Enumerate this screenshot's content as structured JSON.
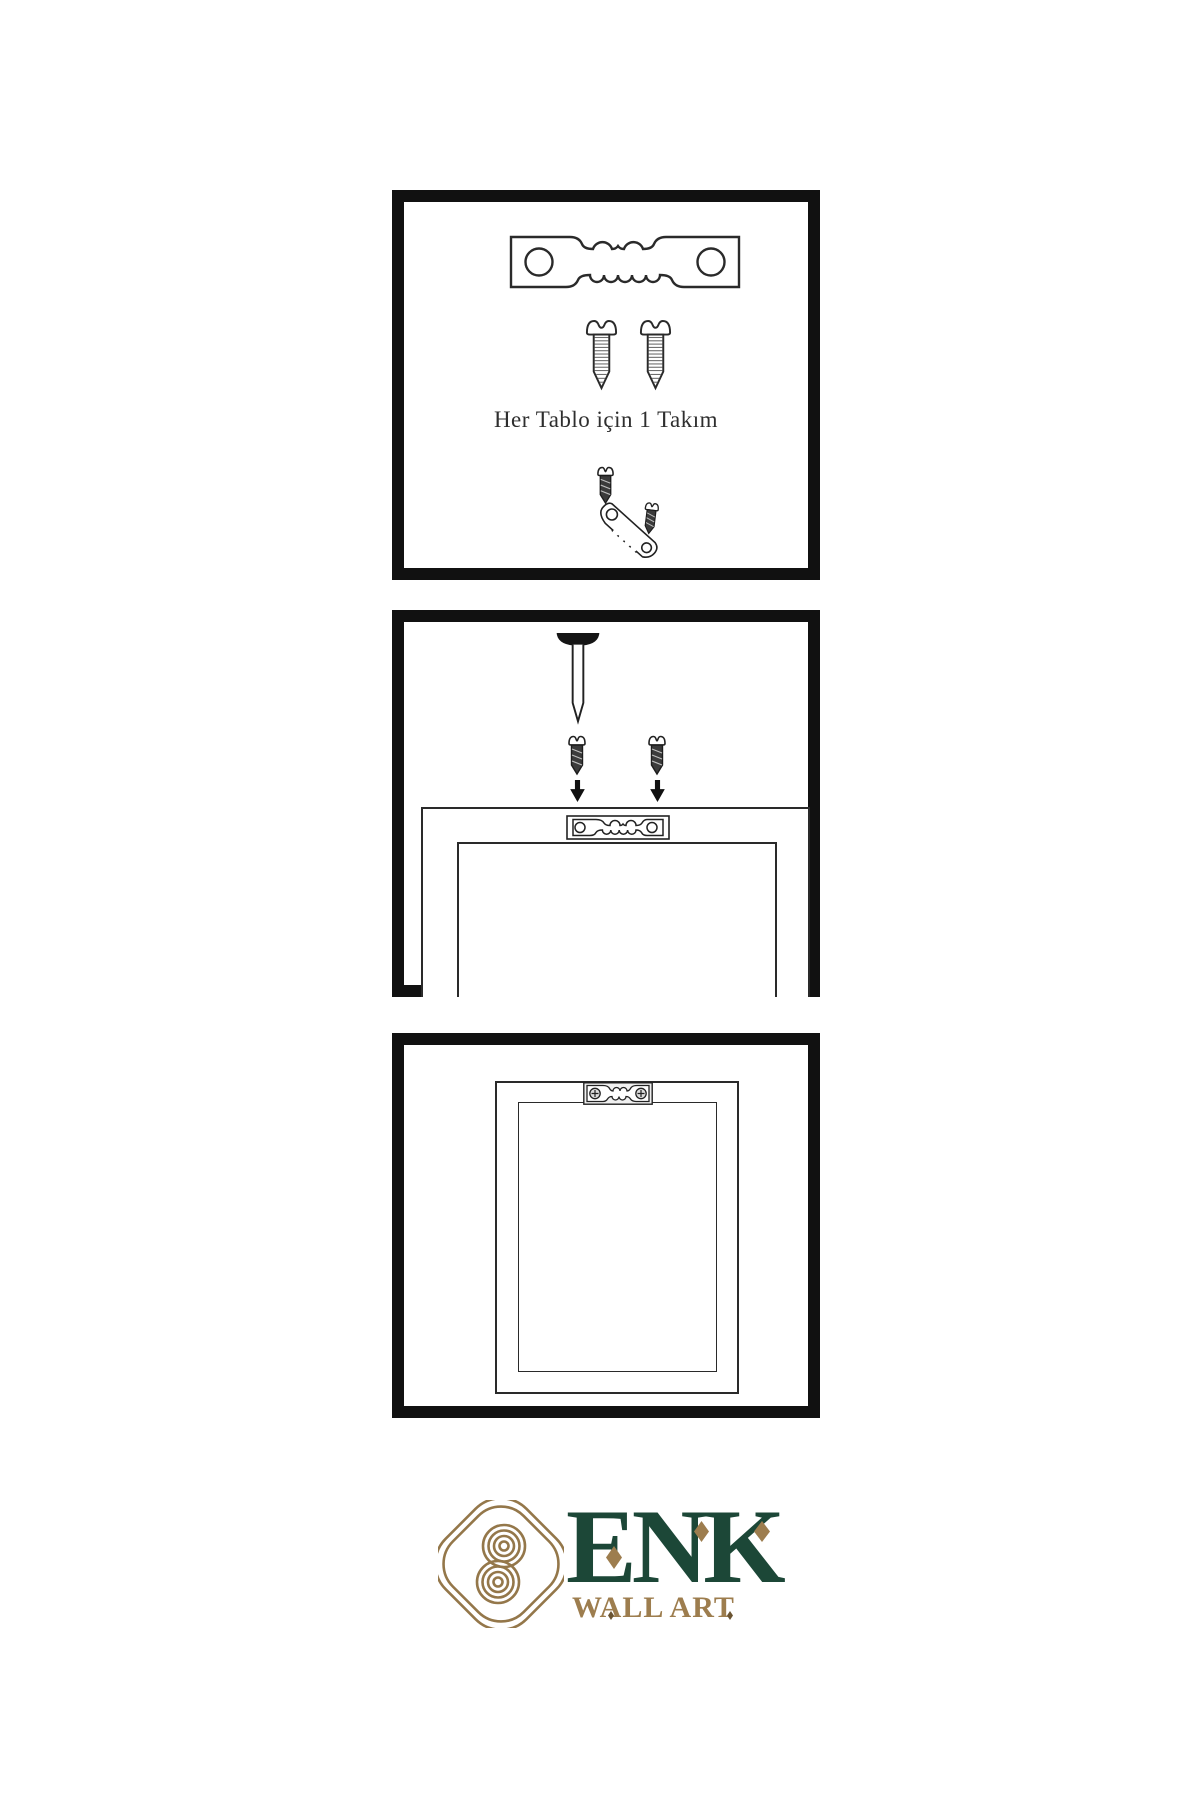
{
  "page": {
    "background_color": "#ffffff",
    "line_color": "#2a2a2a",
    "panel_border_color": "#111111"
  },
  "panels": [
    {
      "name": "hardware-kit",
      "caption": "Her Tablo için 1 Takım",
      "contents": [
        "sawtooth-hanger",
        "screw",
        "screw",
        "screw-driven-into-angled-sawtooth-hanger",
        "screw-dark"
      ]
    },
    {
      "name": "mounting-step",
      "contents": [
        "nail-in-wall",
        "screw-dark-left",
        "screw-dark-right",
        "arrow-down-left",
        "arrow-down-right",
        "frame-back",
        "sawtooth-hanger-plate"
      ]
    },
    {
      "name": "hanging-step",
      "contents": [
        "frame-back",
        "mounted-sawtooth-hanger-with-phillips-screws"
      ]
    }
  ],
  "brand": {
    "name": "ENK",
    "subtitle": "WALL ART",
    "name_color": "#1c4737",
    "subtitle_color": "#9d7d4e",
    "emblem": "interlaced-knot",
    "emblem_color": "#94774a"
  }
}
